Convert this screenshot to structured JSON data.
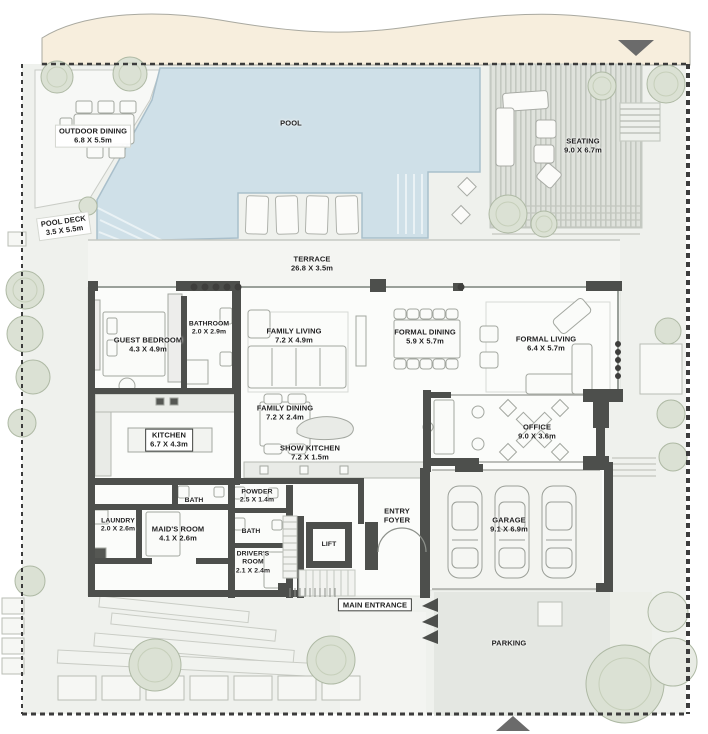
{
  "areas": {
    "outdoor_dining": {
      "name": "OUTDOOR DINING",
      "dims": "6.8 X 5.5m"
    },
    "pool_deck": {
      "name": "POOL DECK",
      "dims": "3.5 X 5.5m"
    },
    "pool": {
      "name": "POOL"
    },
    "seating": {
      "name": "SEATING",
      "dims": "9.0 X 6.7m"
    },
    "terrace": {
      "name": "TERRACE",
      "dims": "26.8 X 3.5m"
    },
    "guest_bedroom": {
      "name": "GUEST BEDROOM",
      "dims": "4.3 X 4.9m"
    },
    "bathroom": {
      "name": "BATHROOM",
      "dims": "2.0 X 2.9m"
    },
    "family_living": {
      "name": "FAMILY LIVING",
      "dims": "7.2 X 4.9m"
    },
    "formal_dining": {
      "name": "FORMAL DINING",
      "dims": "5.9 X 5.7m"
    },
    "formal_living": {
      "name": "FORMAL LIVING",
      "dims": "6.4 X 5.7m"
    },
    "kitchen": {
      "name": "KITCHEN",
      "dims": "6.7 X 4.3m"
    },
    "family_dining": {
      "name": "FAMILY DINING",
      "dims": "7.2 X 2.4m"
    },
    "show_kitchen": {
      "name": "SHOW KITCHEN",
      "dims": "7.2 X 1.5m"
    },
    "office": {
      "name": "OFFICE",
      "dims": "9.0 X 3.6m"
    },
    "bath_upper": {
      "name": "BATH"
    },
    "powder": {
      "name": "POWDER",
      "dims": "2.5 X 1.4m"
    },
    "laundry": {
      "name": "LAUNDRY",
      "dims": "2.0 X 2.6m"
    },
    "maids_room": {
      "name": "MAID'S ROOM",
      "dims": "4.1 X 2.6m"
    },
    "bath_lower": {
      "name": "BATH"
    },
    "drivers_room": {
      "name": "DRIVER'S ROOM",
      "dims": "2.1 X 2.4m"
    },
    "lift": {
      "name": "LIFT"
    },
    "entry_foyer": {
      "name": "ENTRY FOYER"
    },
    "garage": {
      "name": "GARAGE",
      "dims": "9.1 X 6.9m"
    },
    "main_entrance": {
      "name": "MAIN ENTRANCE"
    },
    "parking": {
      "name": "PARKING"
    }
  },
  "icons": {
    "top_boundary_marker": "triangle-down",
    "bottom_boundary_marker": "triangle-up"
  },
  "colors": {
    "sand": "#f7eedd",
    "pool_water": "#cfe0e8",
    "walls": "#4d4f4c",
    "trees": "#dbe1d4",
    "deck": "#dfe2dc",
    "plan_background": "#eff1ed",
    "house_floor": "#fbfcfa",
    "parking": "#e4e7e2"
  }
}
